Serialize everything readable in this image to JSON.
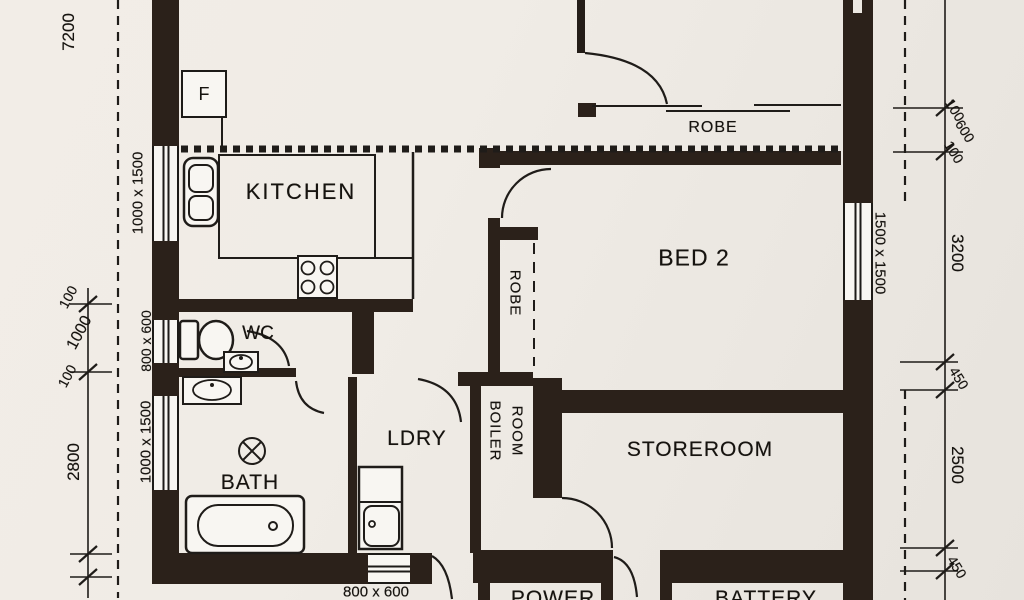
{
  "rooms": {
    "kitchen": "KITCHEN",
    "wc": "WC",
    "bath": "BATH",
    "laundry": "LDRY",
    "boiler_line1": "BOILER",
    "boiler_line2": "ROOM",
    "storeroom": "STOREROOM",
    "bed2": "BED 2",
    "robe_top": "ROBE",
    "robe_bed2": "ROBE",
    "power": "POWER",
    "battery": "BATTERY"
  },
  "fixtures": {
    "fridge": "F"
  },
  "window_labels": {
    "kitchen": "1000 x 1500",
    "wc": "800 x 600",
    "bath": "1000 x 1500",
    "laundry_south": "800 x 600",
    "bed2": "1500 x 1500"
  },
  "dimensions": {
    "left": {
      "overall": "7200",
      "a100": "100",
      "a1000": "1000",
      "b100": "100",
      "c2800": "2800"
    },
    "right": {
      "a100": "100",
      "a600": "600",
      "b100": "100",
      "b3200": "3200",
      "c450": "450",
      "c2500": "2500",
      "d450": "450"
    }
  },
  "colors": {
    "wall": "#2b211a",
    "line": "#1f1c19",
    "paper": "#f0ece7"
  }
}
